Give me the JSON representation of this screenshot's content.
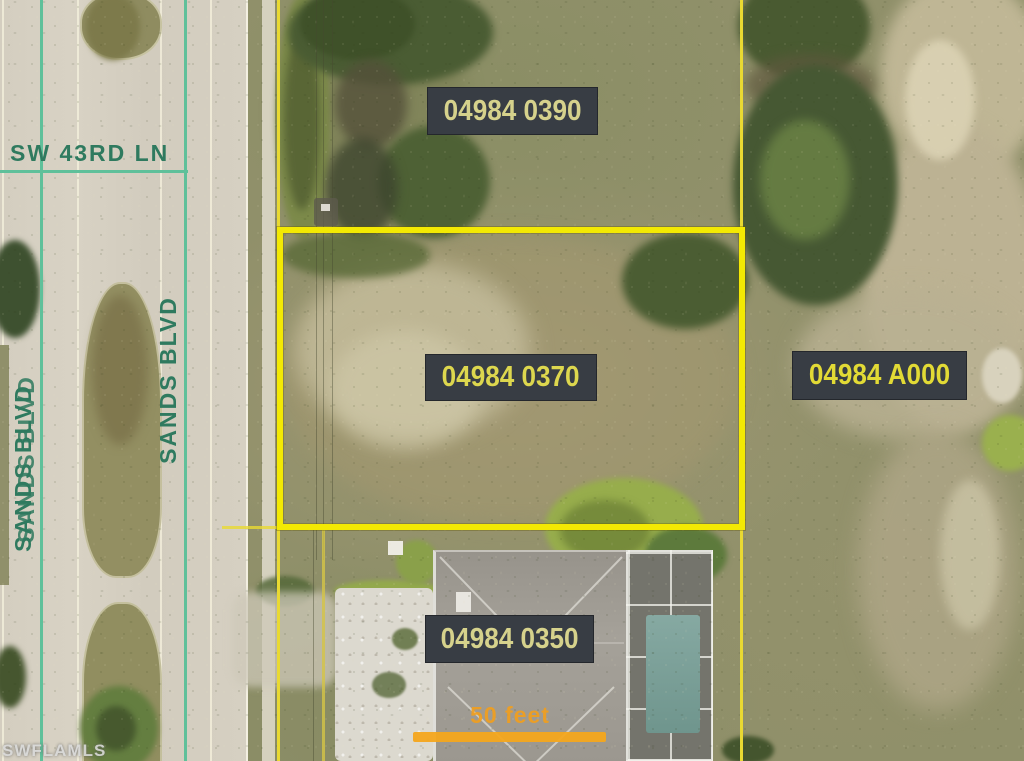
{
  "map": {
    "type": "aerial-parcel-map",
    "parcels": [
      {
        "id": "04984 0390",
        "highlighted": false
      },
      {
        "id": "04984 0370",
        "highlighted": true
      },
      {
        "id": "04984 A000",
        "highlighted": false
      },
      {
        "id": "04984 0350",
        "highlighted": false
      }
    ],
    "streets": [
      {
        "name": "SW 43RD LN"
      },
      {
        "name": "SANDS BLVD"
      },
      {
        "name": "SANDS BLVD"
      }
    ],
    "scale_bar": {
      "label": "50 feet"
    },
    "watermark": "SWFLAMLS",
    "colors": {
      "highlight_outline": "#f3e903",
      "parcel_line": "#e9d932",
      "street_line": "#5fc09a",
      "street_text": "#2f7a5f",
      "label_background": "#383d44",
      "label_text_pale": "#d6d28c",
      "label_text_bright": "#e2da35",
      "scale_bar_orange": "#f4a61e",
      "watermark_text": "#d9d9d9"
    }
  }
}
